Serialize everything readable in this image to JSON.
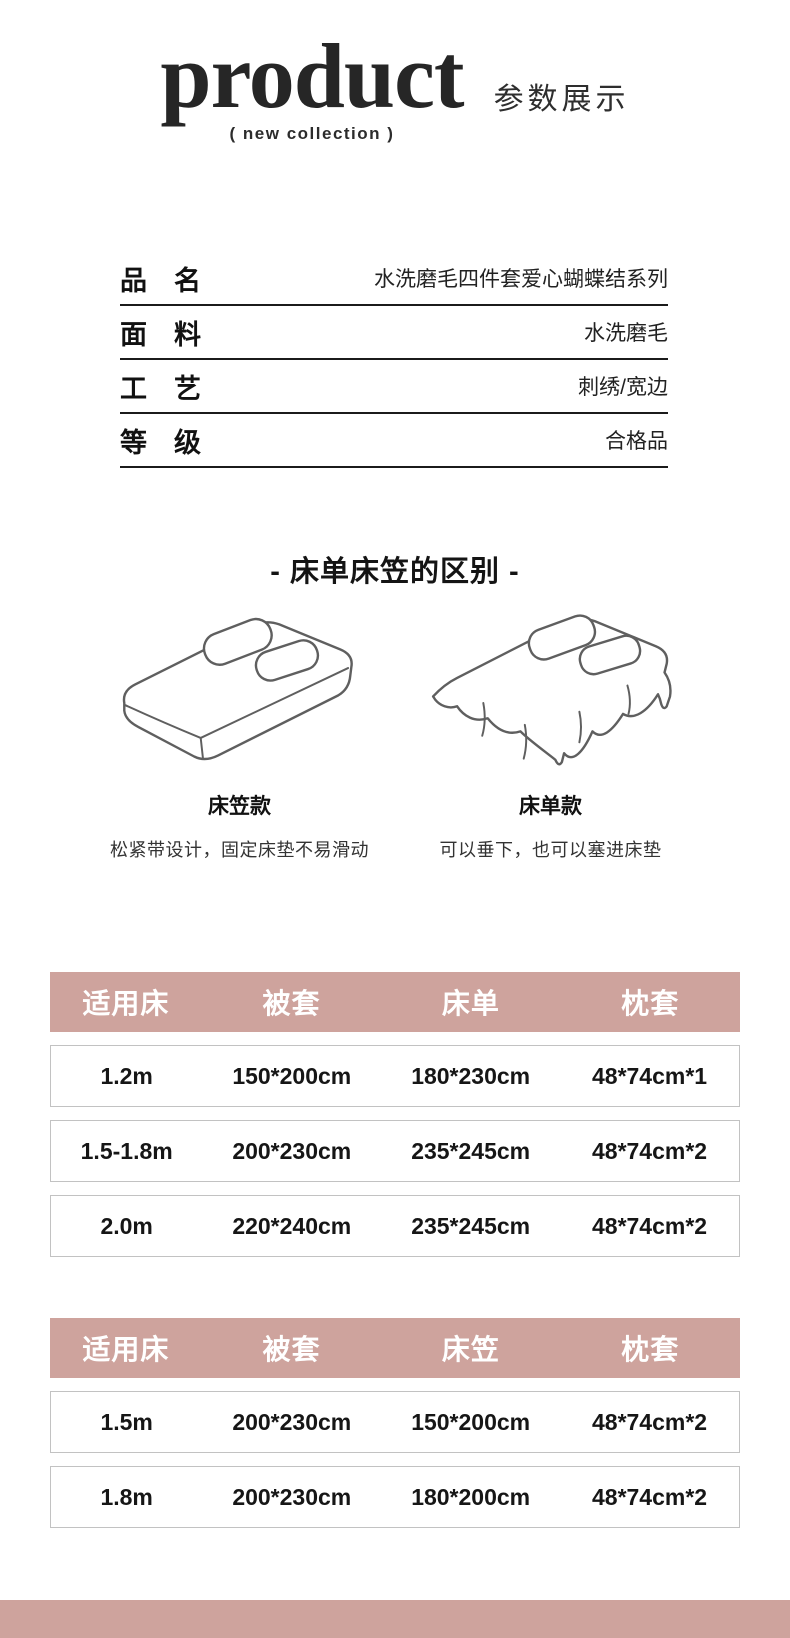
{
  "header": {
    "title": "product",
    "tagline": "(  new collection  )",
    "subtitle": "参数展示"
  },
  "specs": {
    "rows": [
      {
        "label": "品　名",
        "value": "水洗磨毛四件套爱心蝴蝶结系列"
      },
      {
        "label": "面　料",
        "value": "水洗磨毛"
      },
      {
        "label": "工　艺",
        "value": "刺绣/宽边"
      },
      {
        "label": "等　级",
        "value": "合格品"
      }
    ]
  },
  "comparison": {
    "title": "- 床单床笠的区别 -",
    "items": [
      {
        "name": "床笠款",
        "description": "松紧带设计，固定床垫不易滑动",
        "icon": "fitted-sheet-bed-icon"
      },
      {
        "name": "床单款",
        "description": "可以垂下，也可以塞进床垫",
        "icon": "flat-sheet-bed-icon"
      }
    ]
  },
  "size_tables": [
    {
      "headers": [
        "适用床",
        "被套",
        "床单",
        "枕套"
      ],
      "rows": [
        [
          "1.2m",
          "150*200cm",
          "180*230cm",
          "48*74cm*1"
        ],
        [
          "1.5-1.8m",
          "200*230cm",
          "235*245cm",
          "48*74cm*2"
        ],
        [
          "2.0m",
          "220*240cm",
          "235*245cm",
          "48*74cm*2"
        ]
      ]
    },
    {
      "headers": [
        "适用床",
        "被套",
        "床笠",
        "枕套"
      ],
      "rows": [
        [
          "1.5m",
          "200*230cm",
          "150*200cm",
          "48*74cm*2"
        ],
        [
          "1.8m",
          "200*230cm",
          "180*200cm",
          "48*74cm*2"
        ]
      ]
    }
  ],
  "colors": {
    "accent_pink": "#cea39d",
    "row_border": "#c2c2c2",
    "line_black": "#1b1b1b",
    "sketch_stroke": "#5f5f5f"
  }
}
